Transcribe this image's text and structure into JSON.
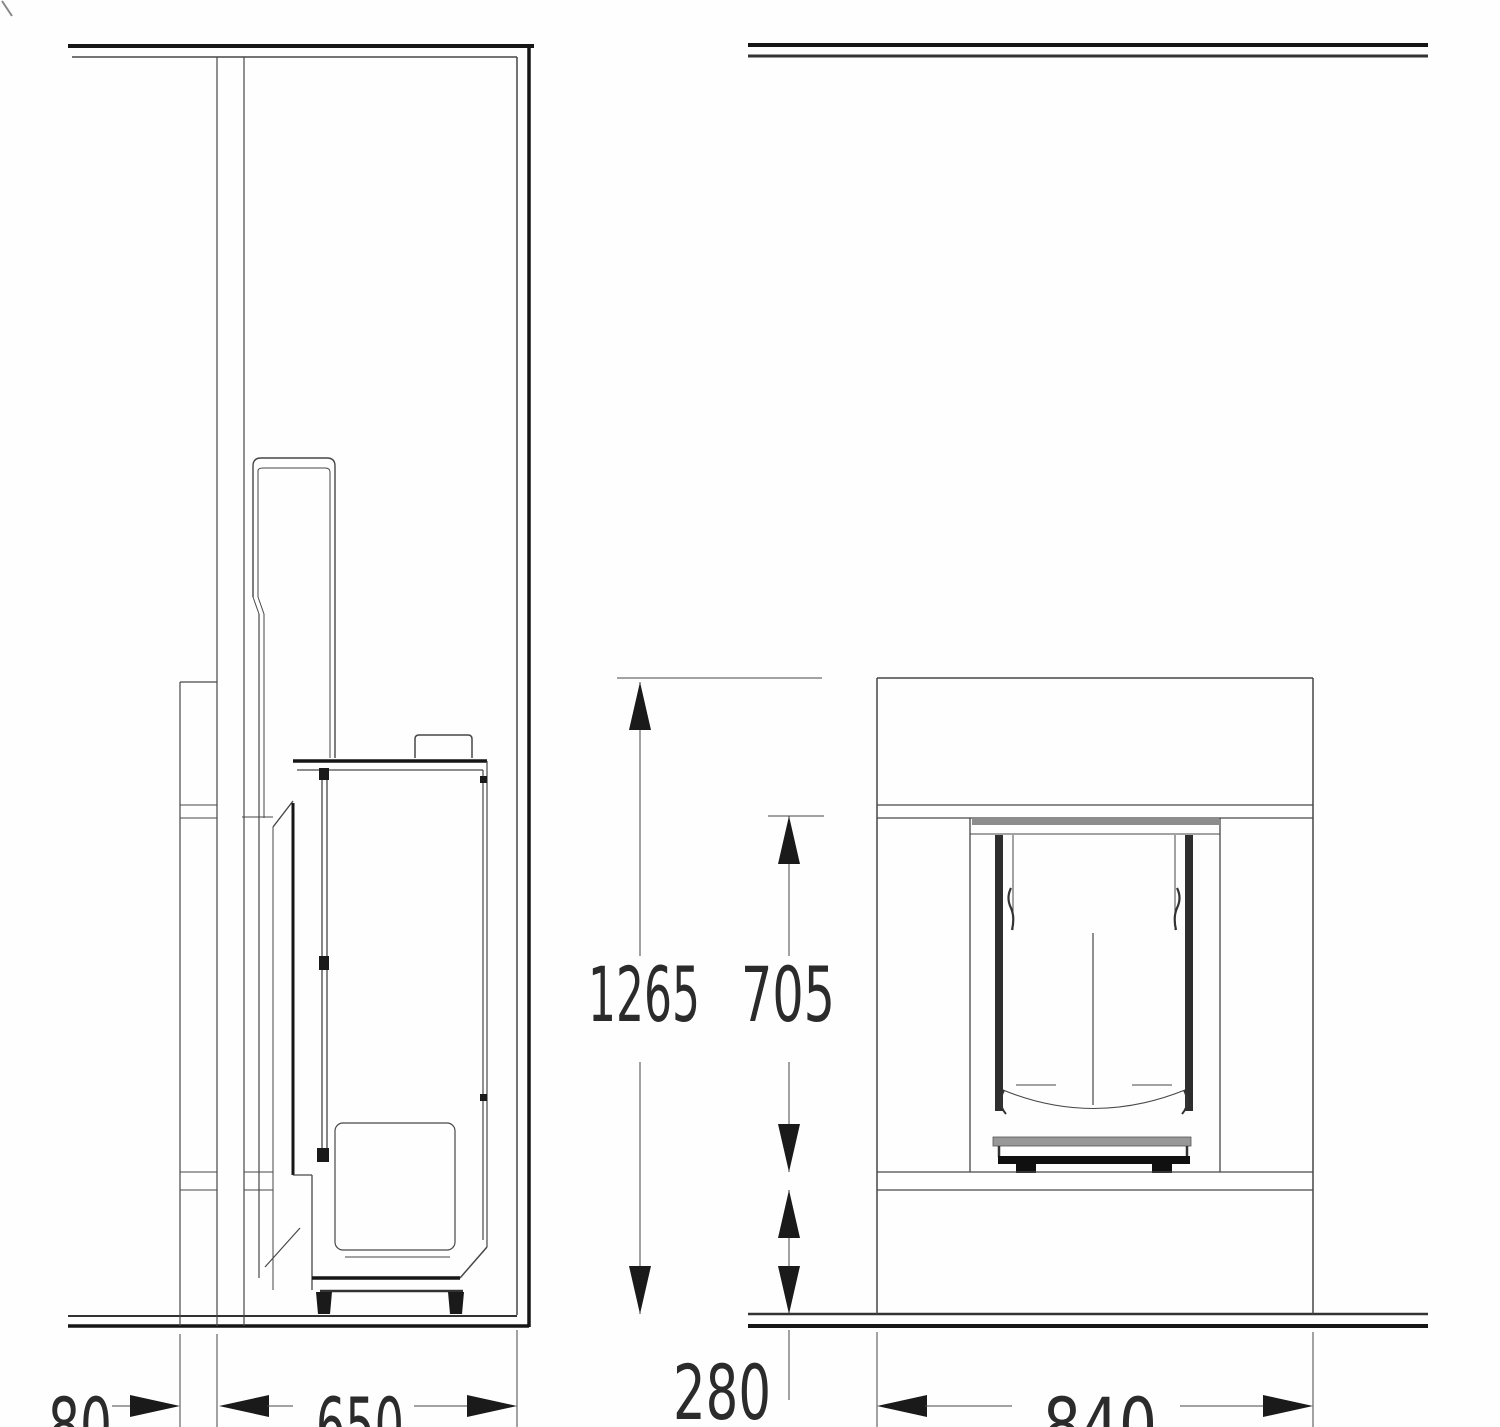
{
  "dims": {
    "total_height": "1265",
    "opening_height": "705",
    "base_height": "280",
    "rear_gap": "80",
    "depth": "650",
    "width": "840"
  },
  "colors": {
    "thin_line": "#474747",
    "heavy_line": "#161616",
    "text": "#2b2b2b",
    "glass_bar": "#2e2e2e",
    "recess_gray": "#8d8d8d",
    "sill_gray": "#989898"
  }
}
